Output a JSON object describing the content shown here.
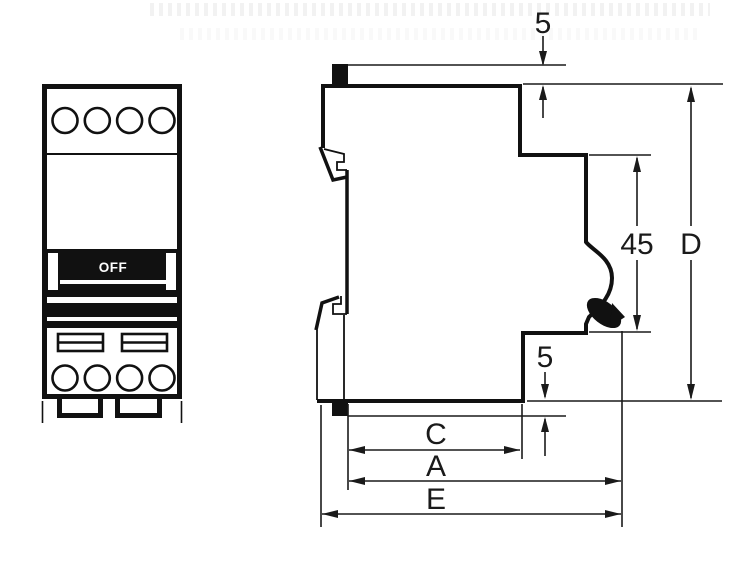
{
  "diagram": {
    "subject": "modular-circuit-breaker-dimension-drawing",
    "colors": {
      "line": "#111111",
      "background": "#ffffff"
    },
    "front_view": {
      "switch_label": "OFF"
    },
    "dimensions": {
      "top_protrusion": "5",
      "bottom_protrusion": "5",
      "front_recess_height": "45",
      "overall_height": "D",
      "body_depth": "C",
      "depth_with_handle": "A",
      "overall_depth": "E"
    }
  }
}
